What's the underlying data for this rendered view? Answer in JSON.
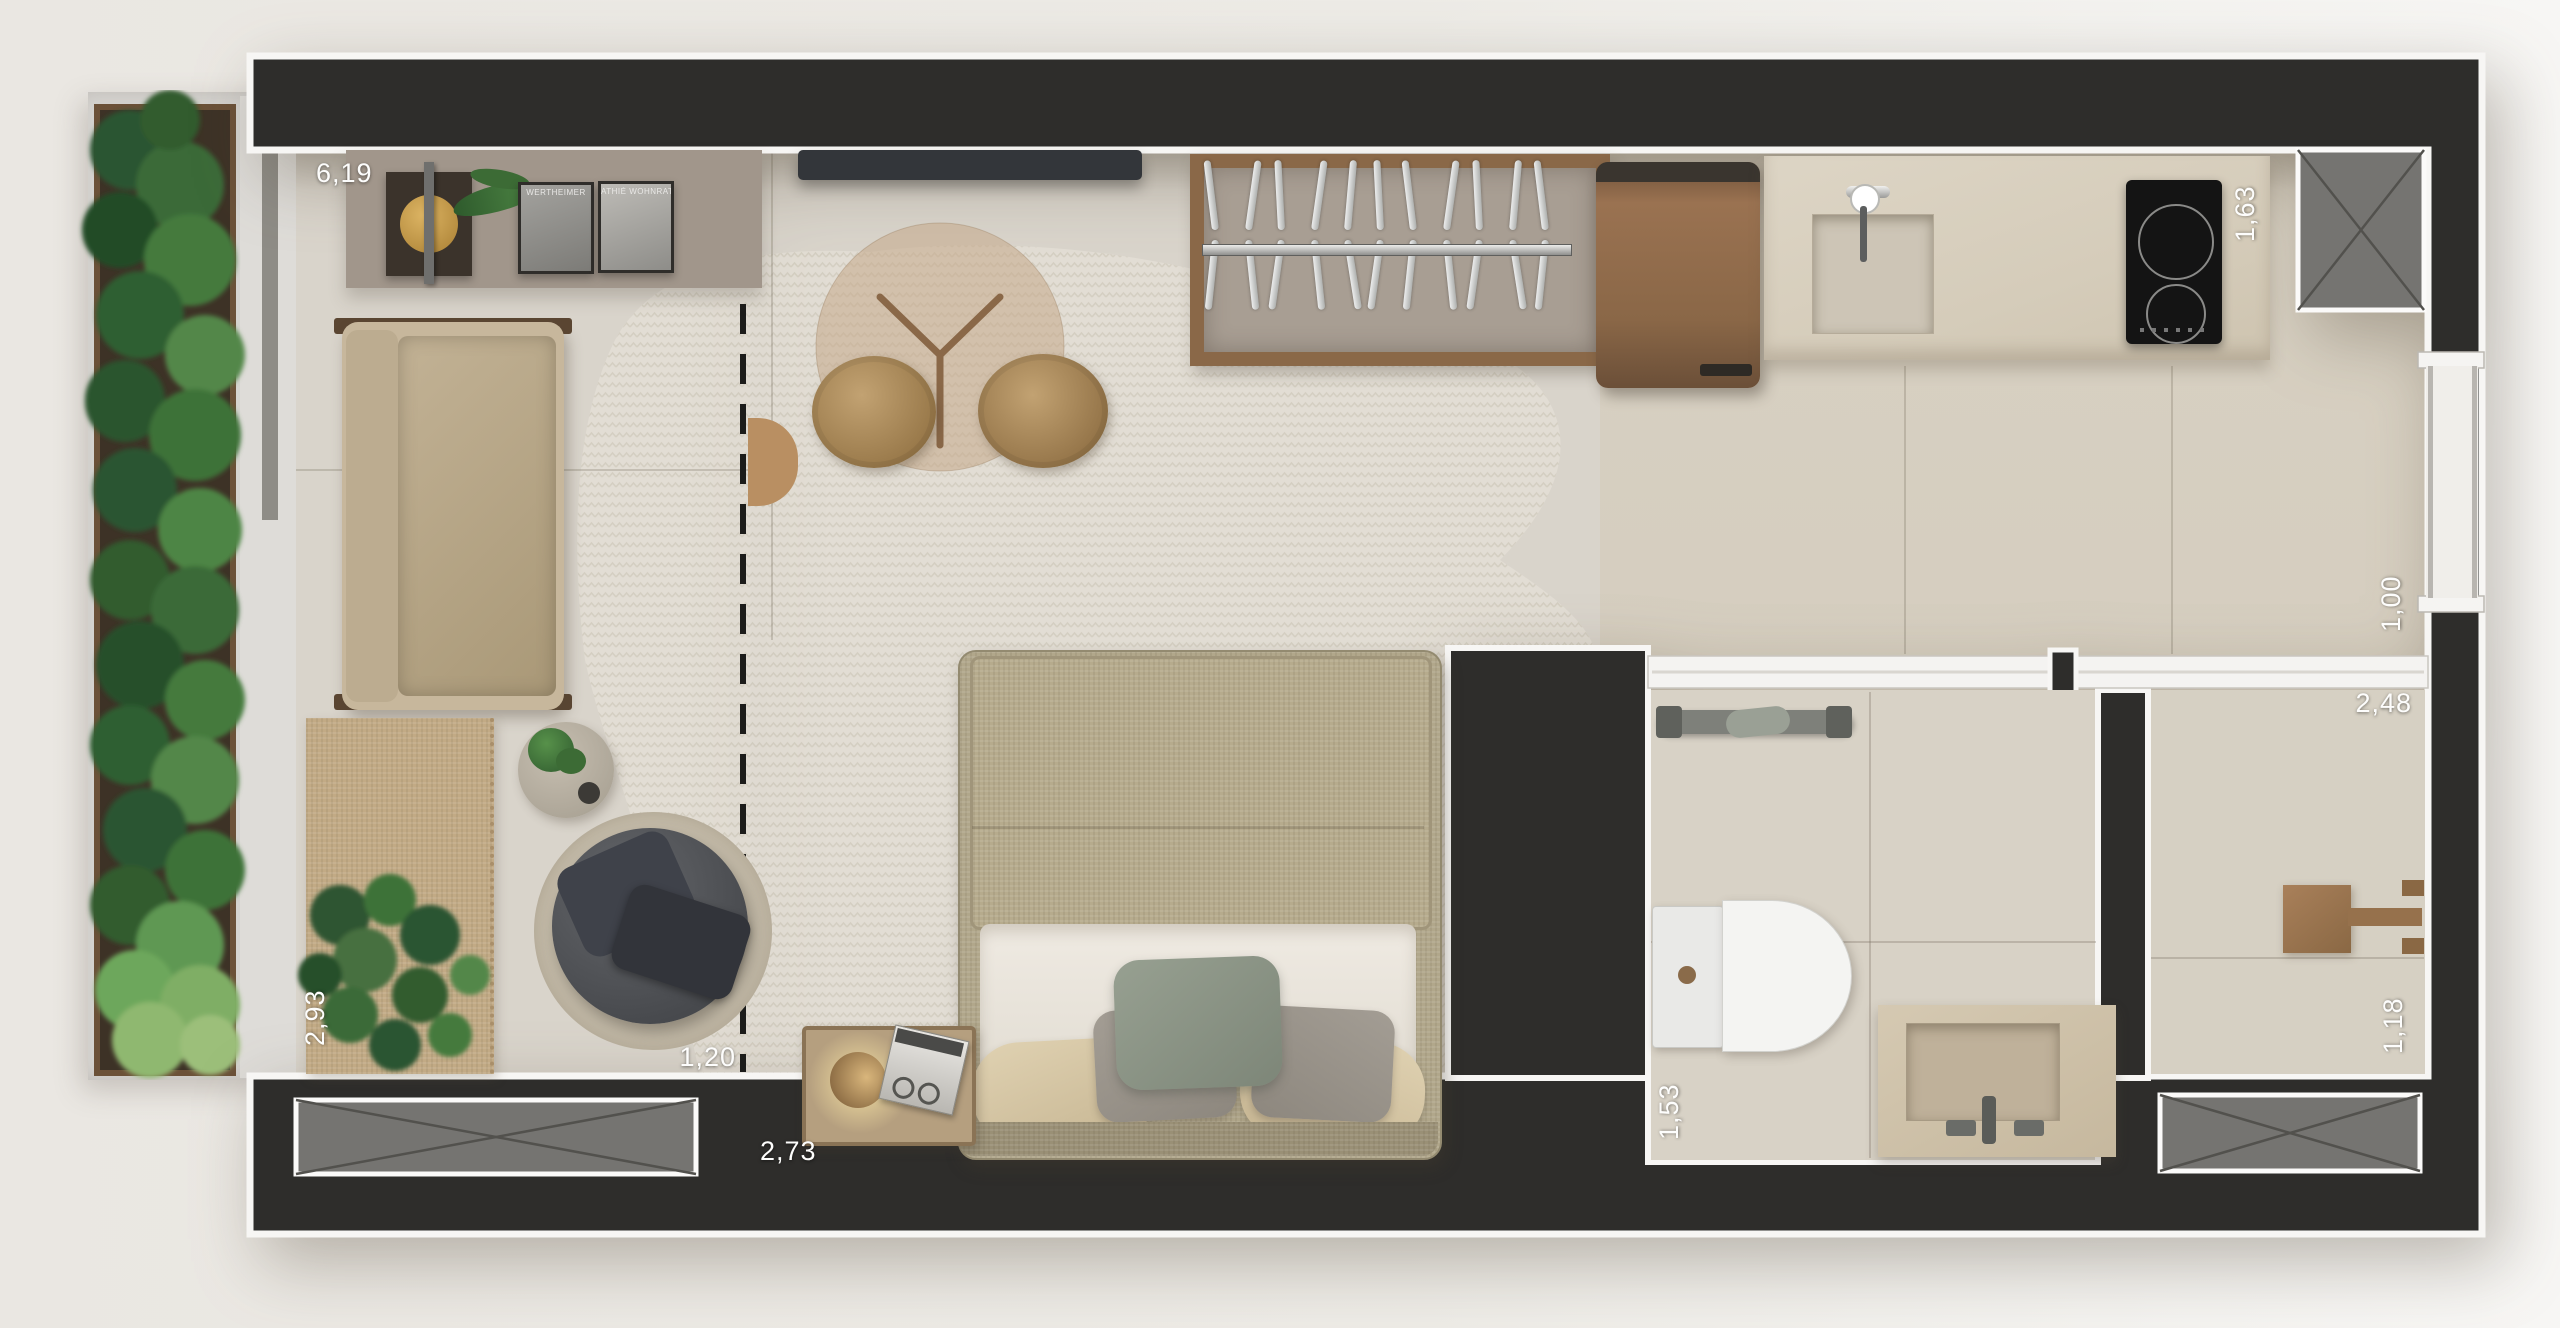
{
  "plan": {
    "measurements": {
      "living_width": "6,19",
      "kitchen_depth": "1,63",
      "hall_window": "1,00",
      "service_width": "2,48",
      "service_depth": "1,18",
      "balcony_depth": "2,93",
      "living_gap": "1,20",
      "bedroom_width": "2,73",
      "bathroom_depth": "1,53"
    },
    "artwork": {
      "frame_left_caption": "WERTHEIMER",
      "frame_right_caption": "ATHIÉ WOHNRATH"
    },
    "colors": {
      "wall": "#2e2d2b",
      "wall_outline": "#f7f6f4",
      "floor_plaster": "#d9d4cb",
      "floor_marble": "#d5cdbf",
      "rug": "#e2ddd4",
      "wood_accent": "#9c7450",
      "plant_green": "#3f6b3c",
      "background": "#edebe7"
    }
  }
}
